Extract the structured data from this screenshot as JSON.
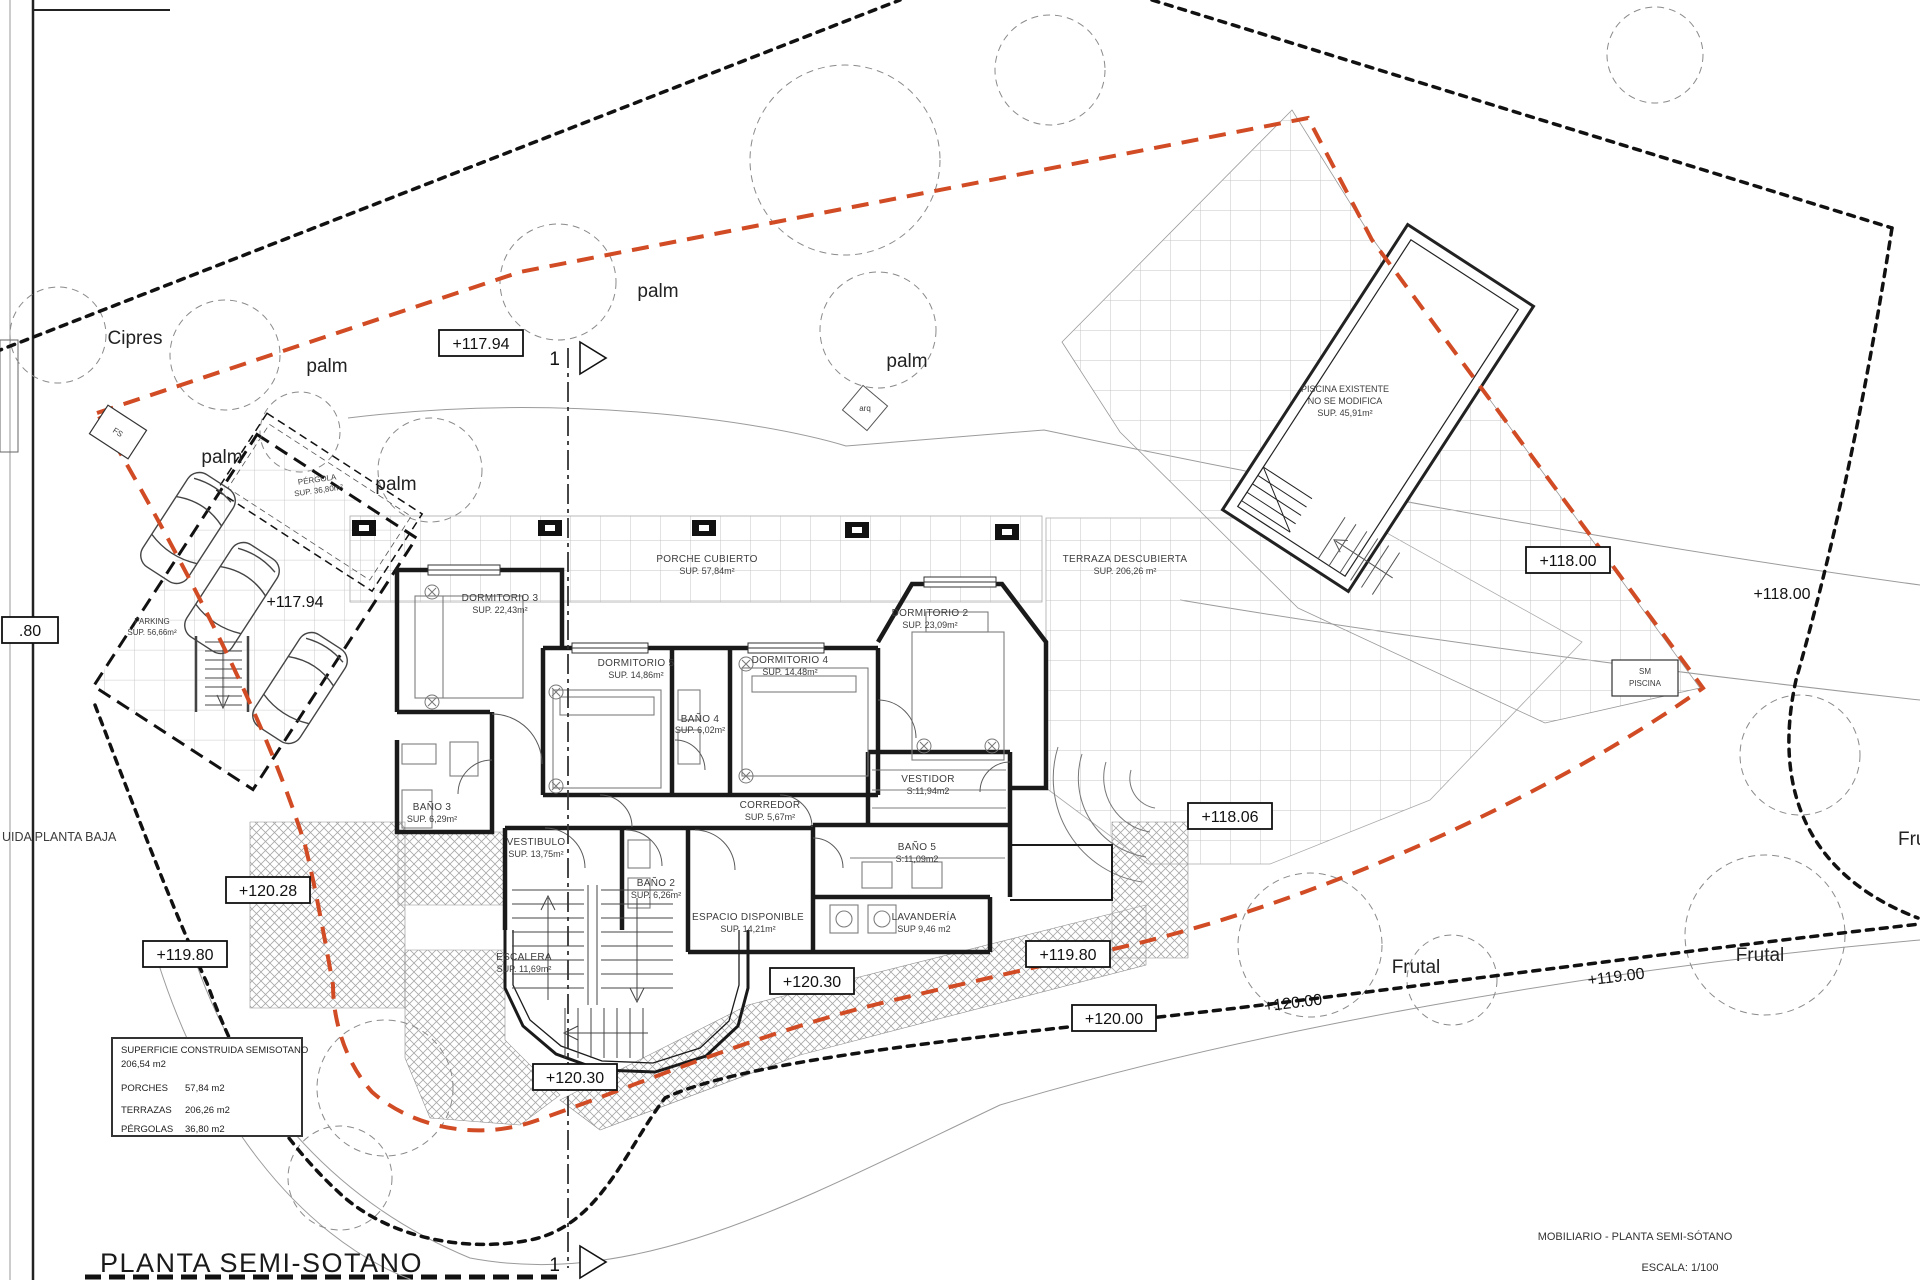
{
  "page": {
    "title": "PLANTA SEMI-SOTANO",
    "footer_title": "MOBILIARIO - PLANTA SEMI-SÓTANO",
    "footer_scale": "ESCALA: 1/100",
    "clipped_note": "UIDA PLANTA BAJA"
  },
  "legend": {
    "title": "SUPERFICIE CONSTRUIDA SEMISOTANO",
    "total": "206,54 m2",
    "porches_label": "PORCHES",
    "porches_value": "57,84 m2",
    "terrazas_label": "TERRAZAS",
    "terrazas_value": "206,26 m2",
    "pergolas_label": "PÉRGOLAS",
    "pergolas_value": "36,80 m2"
  },
  "rooms": {
    "dorm3": {
      "name": "DORMITORIO 3",
      "sup": "SUP. 22,43m²"
    },
    "dorm5": {
      "name": "DORMITORIO 5",
      "sup": "SUP. 14,86m²"
    },
    "dorm4": {
      "name": "DORMITORIO 4",
      "sup": "SUP. 14,48m²"
    },
    "dorm2": {
      "name": "DORMITORIO 2",
      "sup": "SUP. 23,09m²"
    },
    "bano4": {
      "name": "BAÑO 4",
      "sup": "SUP. 6,02m²"
    },
    "bano3": {
      "name": "BAÑO 3",
      "sup": "SUP. 6,29m²"
    },
    "bano2": {
      "name": "BAÑO 2",
      "sup": "SUP. 6,26m²"
    },
    "bano5": {
      "name": "BAÑO 5",
      "sup": "S:11,09m2"
    },
    "vestidor": {
      "name": "VESTIDOR",
      "sup": "S:11,94m2"
    },
    "corredor": {
      "name": "CORREDOR",
      "sup": "SUP. 5,67m²"
    },
    "vestibulo": {
      "name": "VESTIBULO",
      "sup": "SUP. 13,75m²"
    },
    "escalera": {
      "name": "ESCALERA",
      "sup": "SUP. 11,69m²"
    },
    "espacio": {
      "name": "ESPACIO DISPONIBLE",
      "sup": "SUP. 14,21m²"
    },
    "lavanderia": {
      "name": "LAVANDERÍA",
      "sup": "SUP 9,46 m2"
    },
    "porche": {
      "name": "PORCHE CUBIERTO",
      "sup": "SUP. 57,84m²"
    },
    "terraza": {
      "name": "TERRAZA DESCUBIERTA",
      "sup": "SUP. 206,26 m²"
    },
    "pergola": {
      "name": "PÉRGOLA",
      "sup": "SUP. 36,80m²"
    },
    "parking": {
      "name": "PARKING",
      "sup": "SUP. 56,66m²"
    },
    "piscina": {
      "line1": "PISCINA EXISTENTE",
      "line2": "NO SE MODIFICA",
      "line3": "SUP. 45,91m²"
    }
  },
  "trees": {
    "cipres": "Cipres",
    "palm": "palm",
    "frutal": "Frutal"
  },
  "elevations": {
    "e117_94": "+117.94",
    "e118_00": "+118.00",
    "e118_06": "+118.06",
    "e119_00": "+119.00",
    "e119_80": "+119.80",
    "e120_00": "+120.00",
    "e120_28": "+120.28",
    "e120_30": "+120.30",
    "clipped_80": ".80"
  },
  "markers": {
    "fs": "FS",
    "sm_line1": "SM",
    "sm_line2": "PISCINA",
    "arq": "arq",
    "section_number": "1"
  },
  "colors": {
    "plot_line": "#d14b24",
    "ink": "#1a1a1a"
  }
}
